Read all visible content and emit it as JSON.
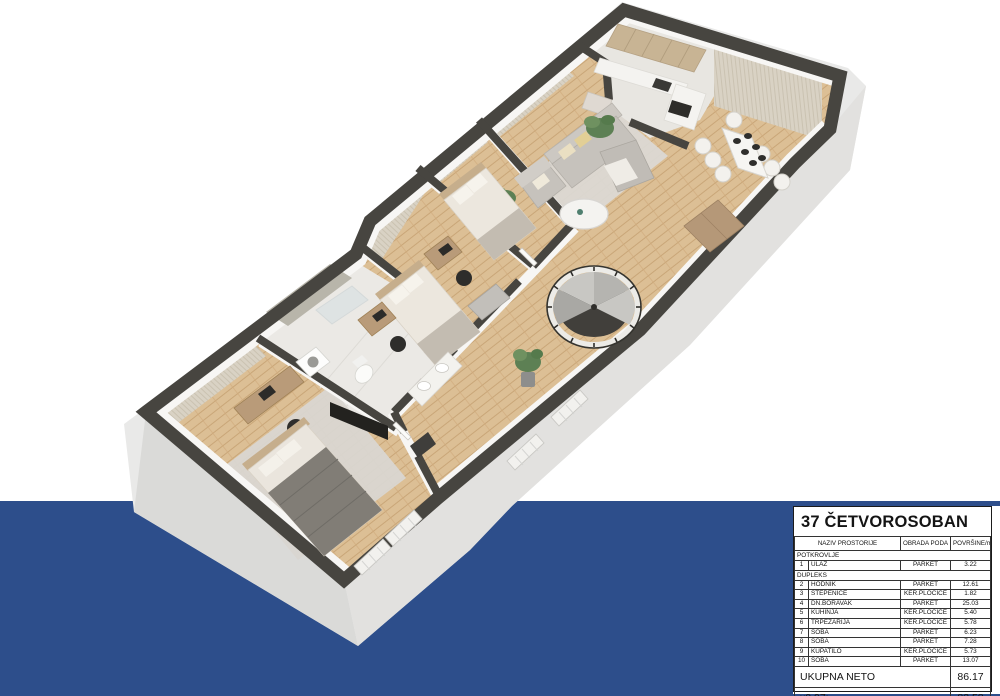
{
  "page": {
    "background": "#ffffff"
  },
  "footer_band": {
    "color": "#2d4e8b"
  },
  "render": {
    "description": "3D isometric cutaway render of a duplex apartment floor plan",
    "colors": {
      "wall_dark": "#474540",
      "wall_face_white": "#f7f6f4",
      "slab": "#e9e9e8",
      "parquet": "#dcbf95",
      "tile": "#e8e6e1",
      "marble": "#ebe9e5",
      "curtain": "#d9d2c4",
      "sofa": "#c6c2bc",
      "master_blanket": "#817d76",
      "cabinet_tan": "#c8b494"
    }
  },
  "table": {
    "title": "37 ČETVOROSOBAN",
    "columns": [
      "NAZIV PROSTORIJE",
      "OBRADA PODA",
      "POVRŠINE/m²"
    ],
    "sections": [
      {
        "label": "POTKROVLJE",
        "rows": [
          {
            "num": "1",
            "name": "ULAZ",
            "floor": "PARKET",
            "area": "3.22"
          }
        ]
      },
      {
        "label": "DUPLEKS",
        "rows": [
          {
            "num": "2",
            "name": "HODNIK",
            "floor": "PARKET",
            "area": "12.61"
          },
          {
            "num": "3",
            "name": "STEPENICE",
            "floor": "KER.PLOČICE",
            "area": "1.82"
          },
          {
            "num": "4",
            "name": "DN.BORAVAK",
            "floor": "PARKET",
            "area": "25.03"
          },
          {
            "num": "5",
            "name": "KUHINJA",
            "floor": "KER.PLOČICE",
            "area": "5.40"
          },
          {
            "num": "6",
            "name": "TRPEZARIJA",
            "floor": "KER.PLOČICE",
            "area": "5.78"
          },
          {
            "num": "7",
            "name": "SOBA",
            "floor": "PARKET",
            "area": "6.23"
          },
          {
            "num": "8",
            "name": "SOBA",
            "floor": "PARKET",
            "area": "7.28"
          },
          {
            "num": "9",
            "name": "KUPATILO",
            "floor": "KER.PLOČICE",
            "area": "5.73"
          },
          {
            "num": "10",
            "name": "SOBA",
            "floor": "PARKET",
            "area": "13.07"
          }
        ]
      }
    ],
    "totals": [
      {
        "label": "UKUPNA NETO",
        "value": "86.17"
      },
      {
        "label": "x0,97:",
        "value": "83.58"
      }
    ]
  }
}
